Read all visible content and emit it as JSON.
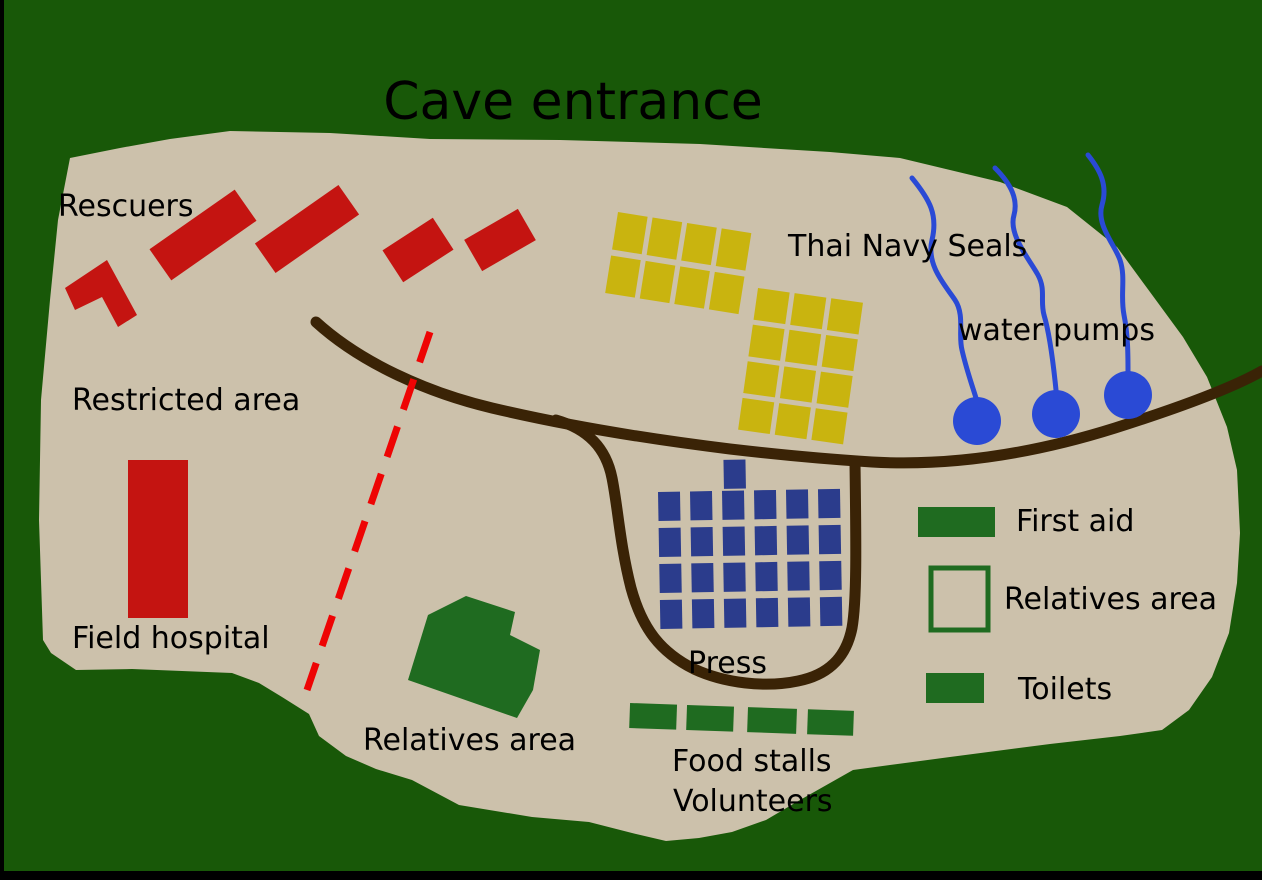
{
  "title": "Cave entrance",
  "labels": {
    "rescuers": "Rescuers",
    "thai_navy_seals": "Thai Navy Seals",
    "water_pumps": "water pumps",
    "restricted_area": "Restricted area",
    "field_hospital": "Field hospital",
    "relatives_area": "Relatives area",
    "press": "Press",
    "food_stalls": "Food stalls",
    "volunteers": "Volunteers"
  },
  "legend": {
    "items": [
      {
        "label": "First aid",
        "swatch": "filled-green-rectangle",
        "color": "#1f6b20"
      },
      {
        "label": "Relatives area",
        "swatch": "outlined-green-square",
        "color": "#1f6b20"
      },
      {
        "label": "Toilets",
        "swatch": "filled-green-rectangle",
        "color": "#1f6b20"
      }
    ]
  },
  "colors": {
    "forest_background": "#185808",
    "camp_ground": "#ccc1ab",
    "road_brown": "#3a2306",
    "rescuer_red": "#c41411",
    "restricted_line_red": "#ee0404",
    "navy_seal_yellow": "#c9b40f",
    "press_navy": "#2b3c8c",
    "water_pump_blue": "#2a4ad5",
    "area_green": "#1f6b20",
    "border_black": "#000000",
    "text_black": "#000000"
  }
}
